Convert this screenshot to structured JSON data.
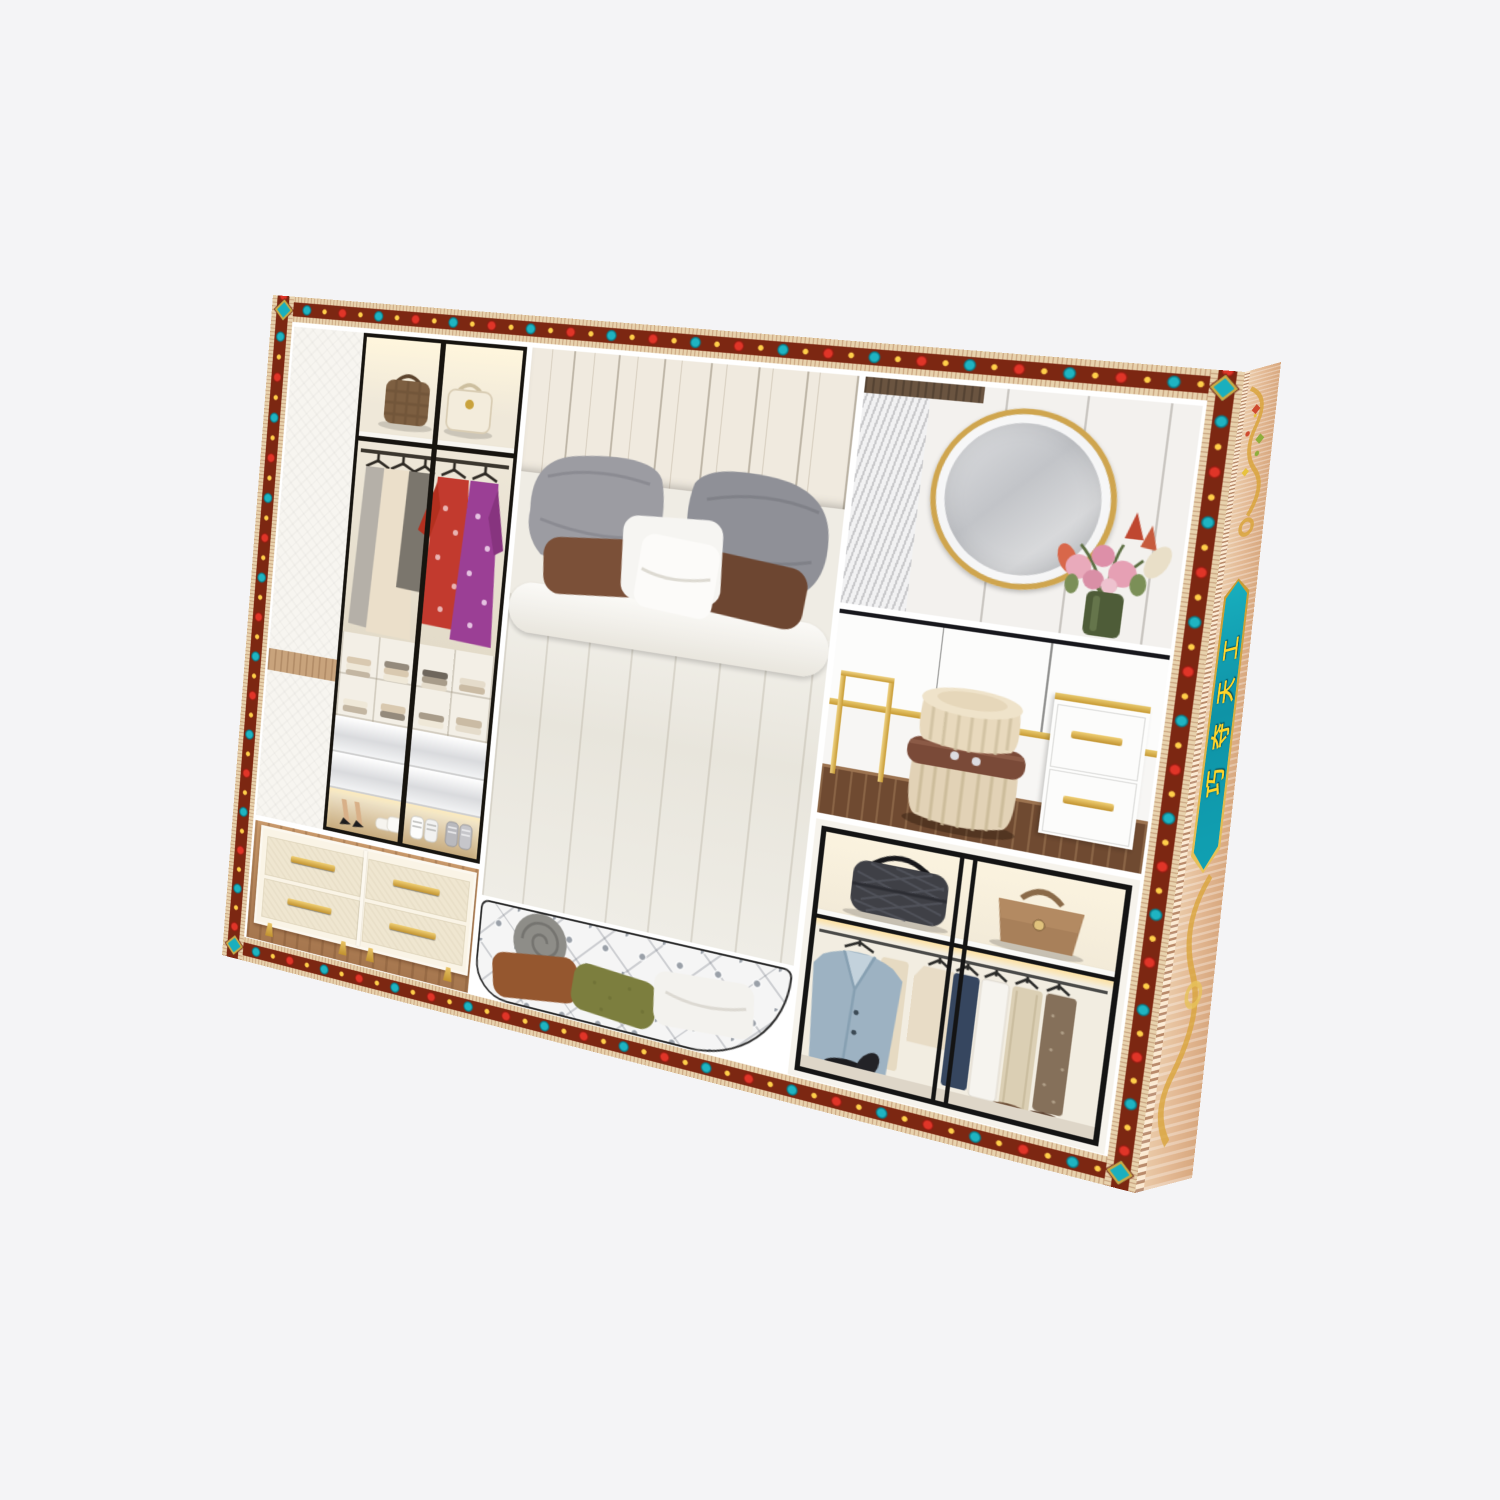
{
  "scene": {
    "type": "product-photo",
    "background_color": "#f4f4f6",
    "description": "Tilted rectangular gift box with jeweled ethnic ornamental border, printed with a bedroom wardrobe photo collage"
  },
  "box": {
    "side_banner": {
      "text": "巧夺天工",
      "banner_color": "#119fb2",
      "rim_color": "#c79a33",
      "text_color": "#ffd42a"
    },
    "border": {
      "base_tan": "#e8d2ad",
      "band_maroon": "#7c2712",
      "gem_red": "#d8332a",
      "gem_teal": "#1aafbe",
      "gold": "#f1c53f"
    },
    "side_panel": {
      "wood_color": "#e3b994",
      "ornament_gold": "#d9a53c"
    },
    "panels": {
      "wardrobe": "white wardrobe with glass sliding doors: two handbags on top shelf, hanging dresses and red and purple floral kimonos, folded clothes cubbies, glossy drawers, heels and sneakers below",
      "dresser": "cream four-drawer dresser with gold bar handles and gold legs on wood floor",
      "bed": "upholstered panel headboard bed with two grey pillows, two brown pillows, white pillows and white channel-quilted duvet",
      "bench": "round white button-tufted bench with grey round cushion, rust and olive pillows",
      "vanity": "round gold-framed LED mirror on white paneled wall with pink rose bouquet in green vase",
      "cabinet": "white wall cabinets with gold trim, gold-frame console, pleated cream pouf with brown studded belt, white drawer unit with gold handles",
      "closet": "black-framed closet: checkered duffel and tan briefcase on shelf, light blue suit, cream and navy shirts, coats, black derby shoes and brown loafers"
    }
  }
}
